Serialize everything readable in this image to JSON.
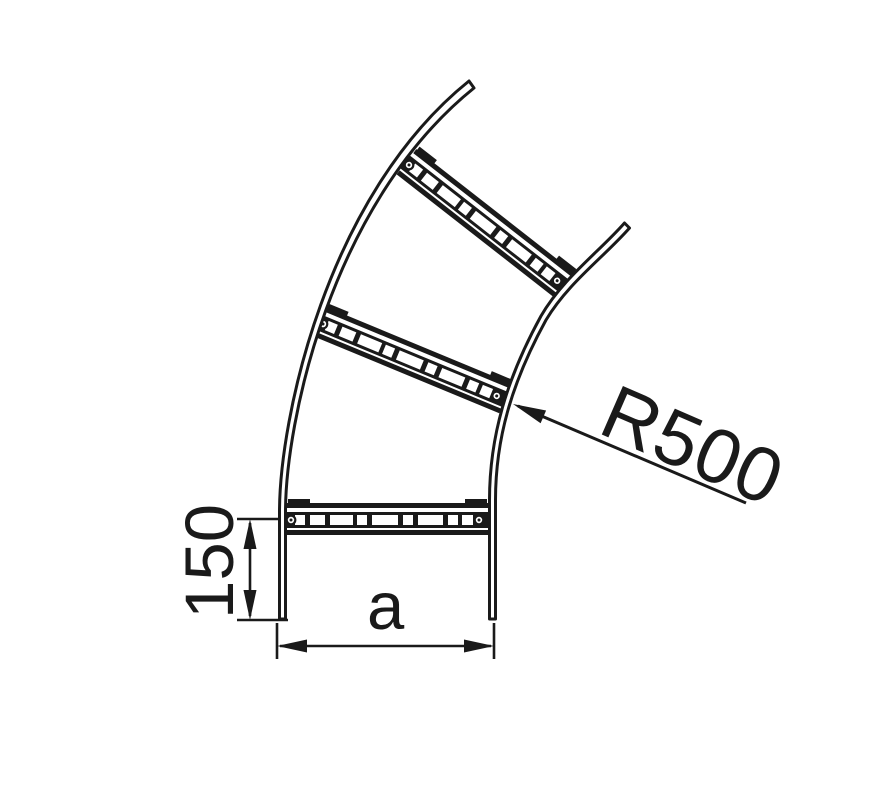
{
  "diagram": {
    "type": "technical-line-drawing",
    "subject": "cable-ladder-vertical-bend",
    "labels": {
      "radius": "R500",
      "tangent_height": "150",
      "width": "a"
    }
  },
  "colors": {
    "ink": "#1a1a1a",
    "background": "#ffffff"
  }
}
